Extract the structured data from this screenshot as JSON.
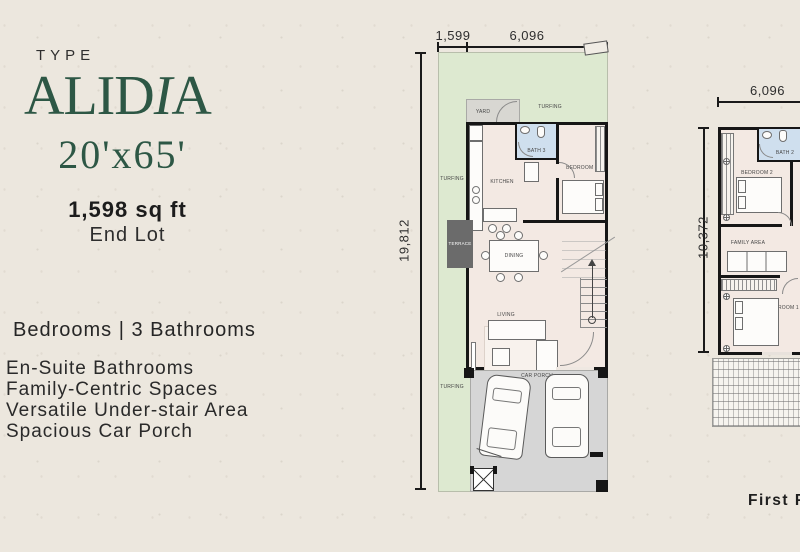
{
  "title": {
    "type_label": "TYPE",
    "name_pre": "ALID",
    "name_italic": "I",
    "name_post": "A",
    "size": "20'x65'",
    "area": "1,598 sq ft",
    "lot_type": "End Lot"
  },
  "summary": {
    "rooms_line": "Bedrooms | 3 Bathrooms",
    "features": [
      "En-Suite Bathrooms",
      "Family-Centric Spaces",
      "Versatile Under-stair Area",
      "Spacious Car Porch"
    ]
  },
  "ground_floor": {
    "dim_width_left": "1,599",
    "dim_width_right": "6,096",
    "dim_height": "19,812",
    "labels": {
      "turfing_top": "TURFING",
      "turfing_left": "TURFING",
      "turfing_bottom": "TURFING",
      "yard": "YARD",
      "kitchen": "KITCHEN",
      "bath": "BATH 3",
      "bedroom": "BEDROOM 4",
      "dining": "DINING",
      "terrace": "TERRACE",
      "living": "LIVING",
      "car_porch": "CAR PORCH"
    }
  },
  "first_floor": {
    "caption": "First Fl",
    "dim_width": "6,096",
    "dim_height": "10,372",
    "labels": {
      "bath": "BATH 2",
      "bedroom2": "BEDROOM 2",
      "family": "FAMILY AREA",
      "bedroom1": "BEDROOM 1"
    }
  },
  "colors": {
    "background": "#ece7de",
    "accent": "#2d5745",
    "turf": "#dde9d0",
    "floor": "#f3e9e3",
    "bath": "#cfdfee",
    "porch": "#d6d6d6",
    "terrace": "#6b6b6b",
    "wall": "#161616"
  }
}
